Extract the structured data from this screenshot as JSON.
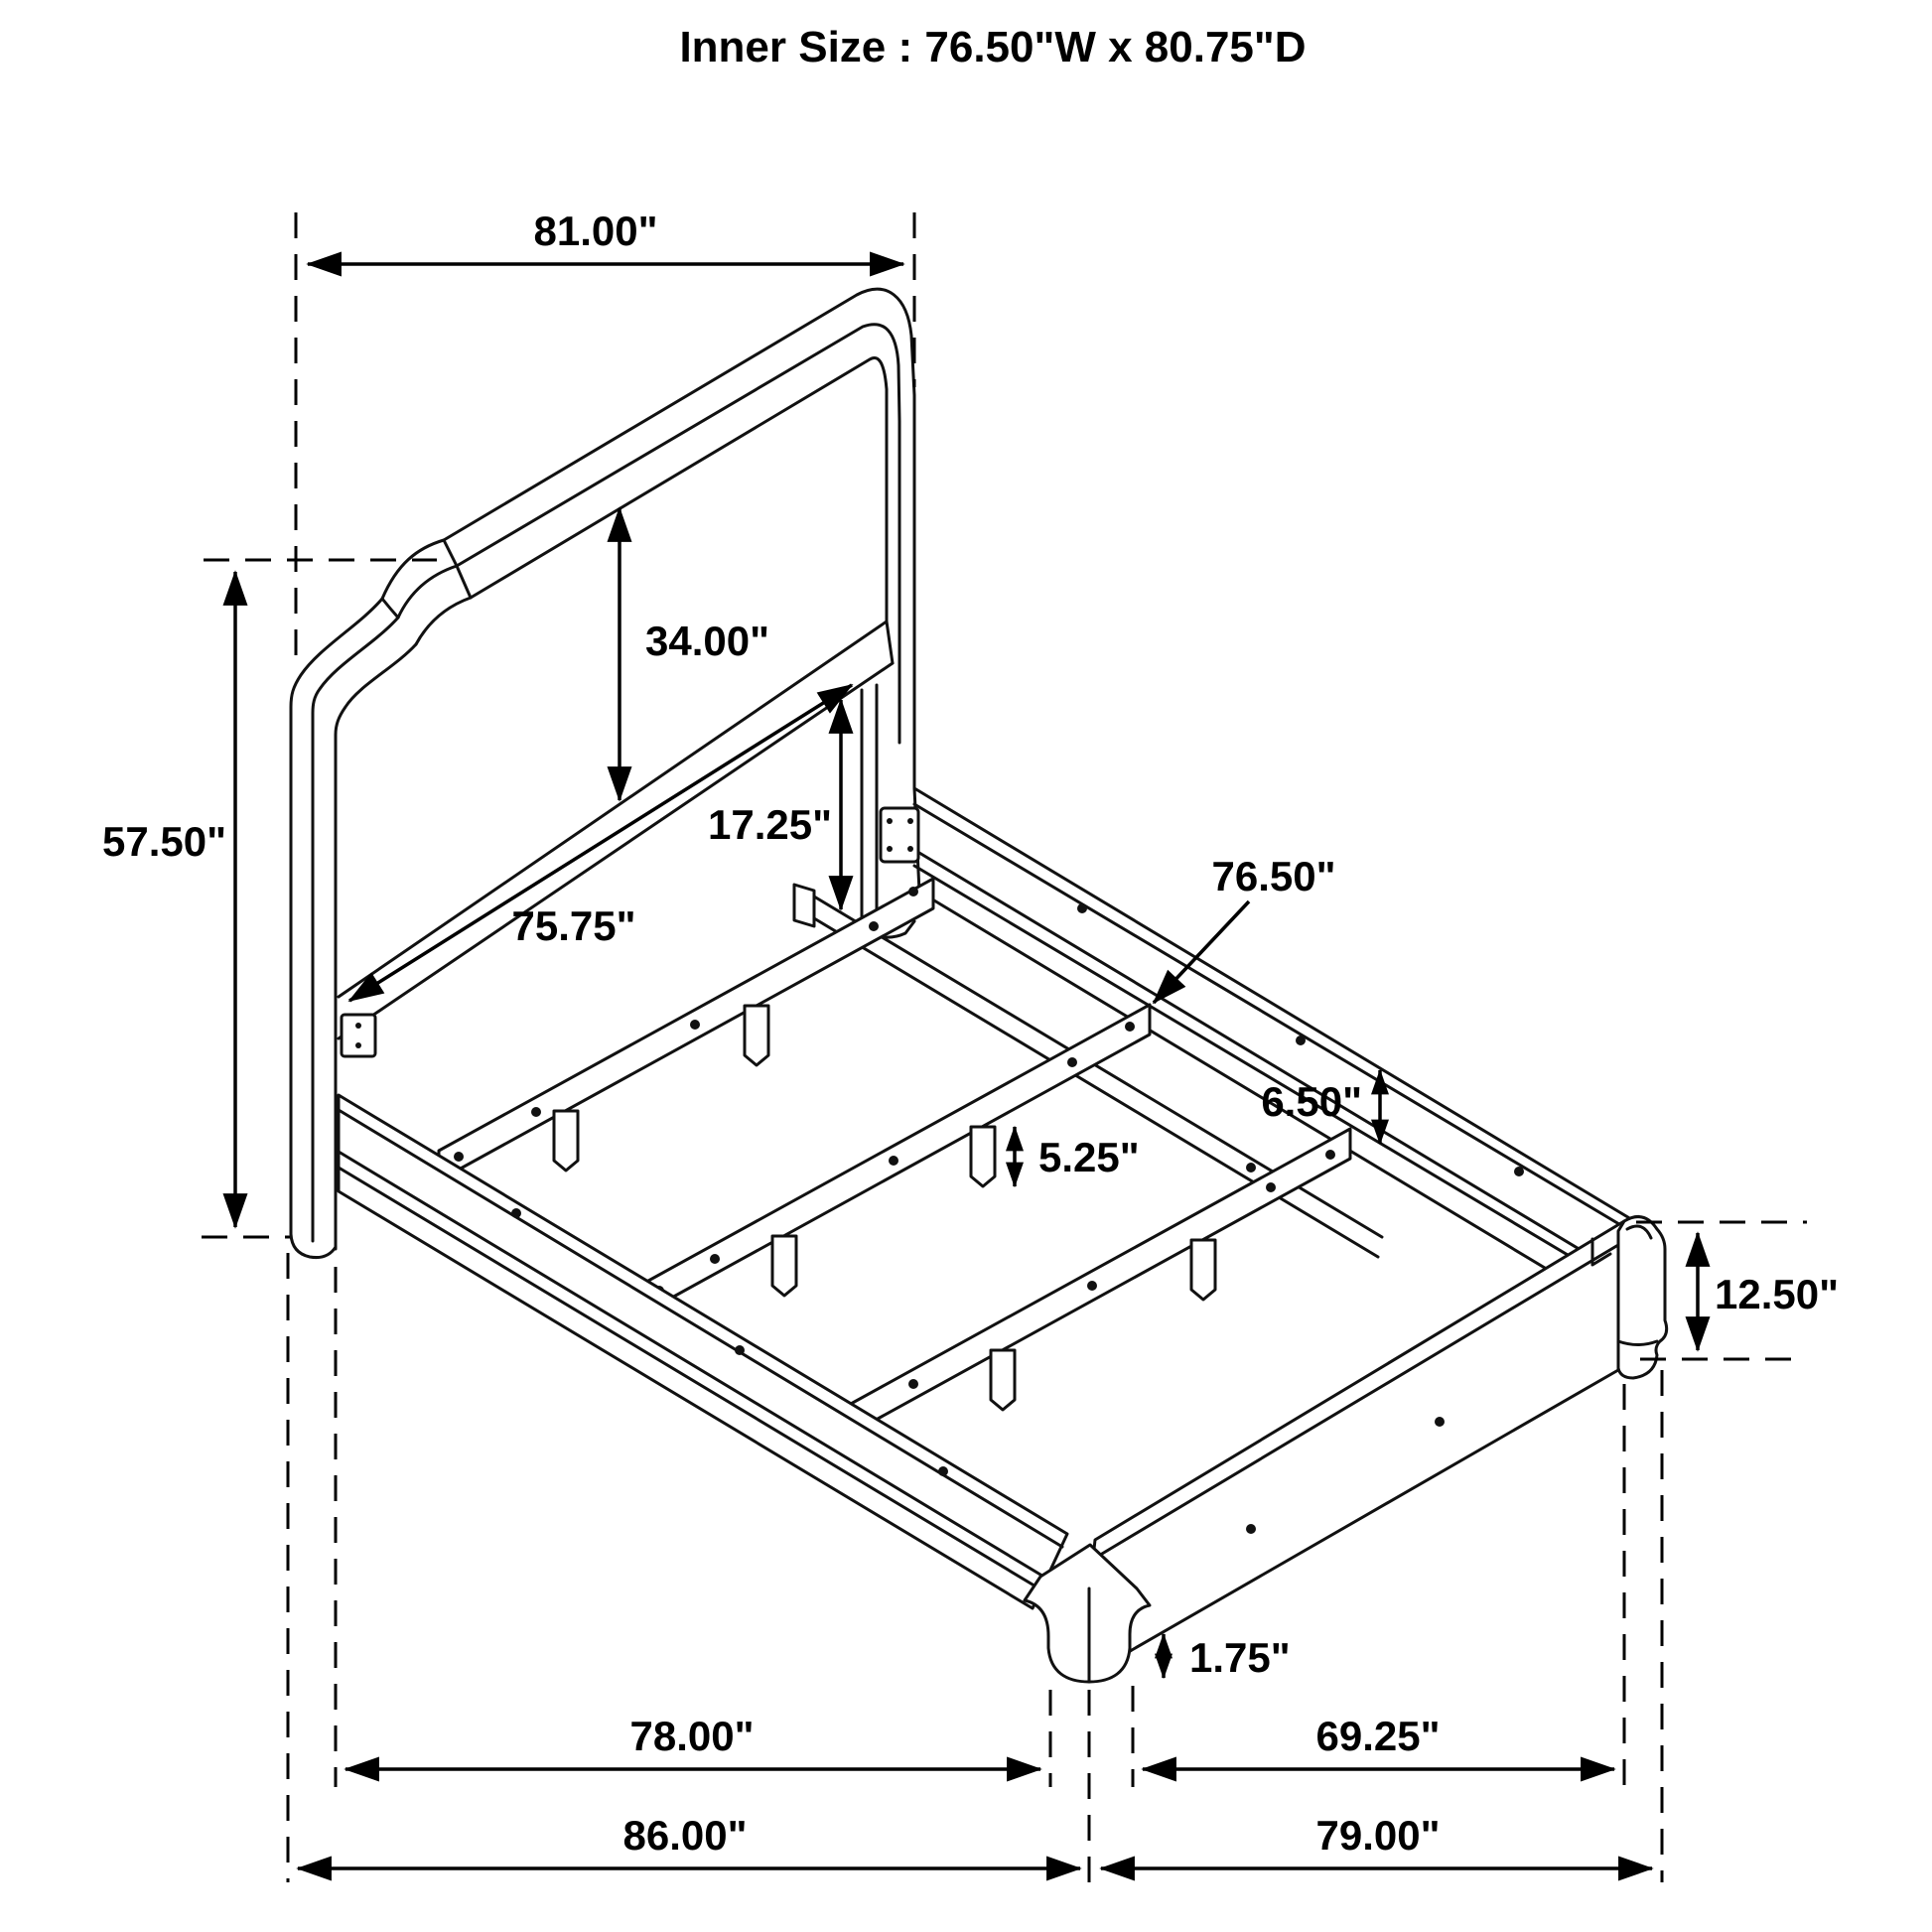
{
  "title": "Inner Size : 76.50\"W x 80.75\"D",
  "diagram": {
    "kind": "bed-frame-dimension-drawing",
    "dimensions": {
      "headboard_width": "81.00\"",
      "headboard_total_height": "57.50\"",
      "headboard_panel_height": "34.00\"",
      "headboard_inner_width": "75.75\"",
      "rail_top_to_slat_height": "17.25\"",
      "slat_length": "76.50\"",
      "side_rail_height": "6.50\"",
      "slat_leg_height": "5.25\"",
      "footboard_corner_height": "12.50\"",
      "foot_height": "1.75\"",
      "inner_frame_length": "78.00\"",
      "footboard_inner_length": "69.25\"",
      "overall_length": "86.00\"",
      "side_rail_length": "79.00\""
    }
  }
}
